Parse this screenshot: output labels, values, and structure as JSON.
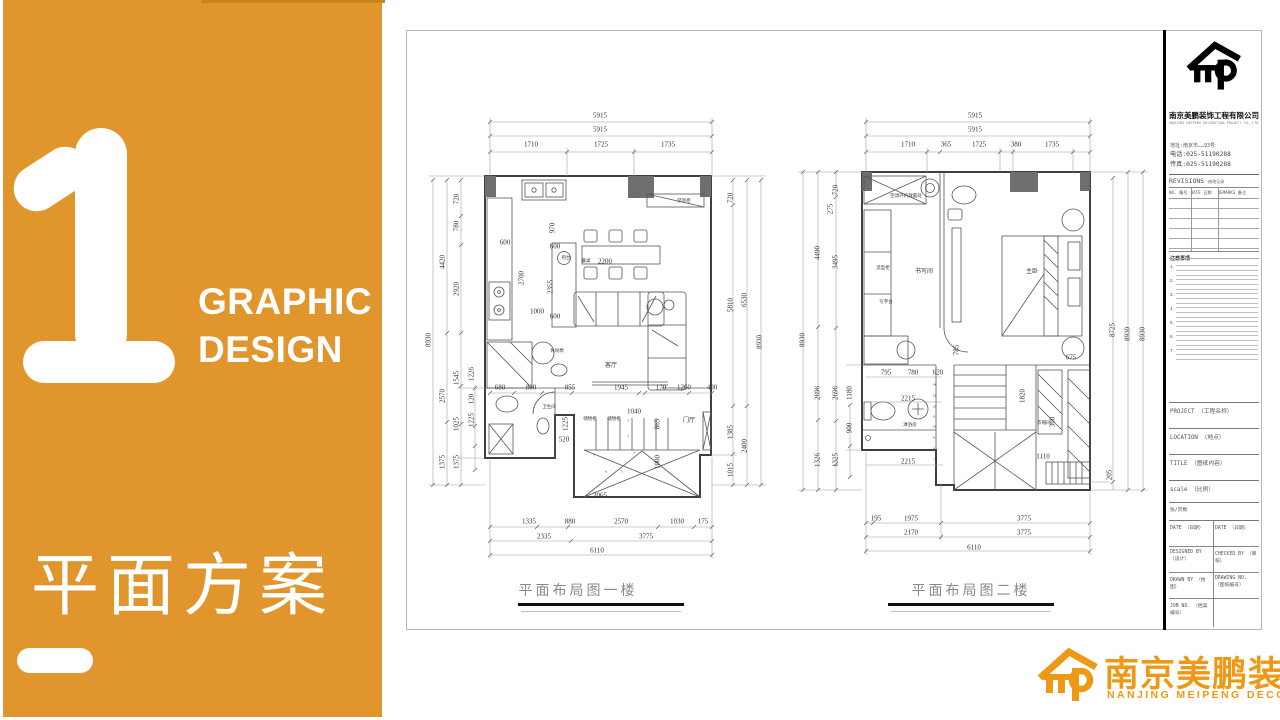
{
  "left_panel": {
    "number": "1",
    "subtitle_line1": "GRAPHIC",
    "subtitle_line2": "DESIGN",
    "title": "平面方案",
    "bg_color": "#E0952D"
  },
  "sheet": {
    "plan1": {
      "title": "平面布局图一楼",
      "dims": [
        {
          "t": "5915",
          "x": 600,
          "y": 116
        },
        {
          "t": "5915",
          "x": 600,
          "y": 130
        },
        {
          "t": "1710",
          "x": 531,
          "y": 145
        },
        {
          "t": "1725",
          "x": 601,
          "y": 145
        },
        {
          "t": "1735",
          "x": 668,
          "y": 145
        },
        {
          "t": "8930",
          "x": 429,
          "y": 340,
          "r": 1
        },
        {
          "t": "4420",
          "x": 443,
          "y": 262,
          "r": 1
        },
        {
          "t": "2570",
          "x": 443,
          "y": 396,
          "r": 1
        },
        {
          "t": "1375",
          "x": 443,
          "y": 462,
          "r": 1
        },
        {
          "t": "720",
          "x": 457,
          "y": 199,
          "r": 1
        },
        {
          "t": "780",
          "x": 457,
          "y": 226,
          "r": 1
        },
        {
          "t": "2920",
          "x": 457,
          "y": 289,
          "r": 1
        },
        {
          "t": "1545",
          "x": 457,
          "y": 378,
          "r": 1
        },
        {
          "t": "1025",
          "x": 457,
          "y": 424,
          "r": 1
        },
        {
          "t": "1375",
          "x": 457,
          "y": 462,
          "r": 1
        },
        {
          "t": "1226",
          "x": 472,
          "y": 374,
          "r": 1
        },
        {
          "t": "120",
          "x": 472,
          "y": 399,
          "r": 1
        },
        {
          "t": "1225",
          "x": 472,
          "y": 420,
          "r": 1
        },
        {
          "t": "720",
          "x": 731,
          "y": 198,
          "r": 1
        },
        {
          "t": "5810",
          "x": 731,
          "y": 305,
          "r": 1
        },
        {
          "t": "1385",
          "x": 731,
          "y": 432,
          "r": 1
        },
        {
          "t": "1015",
          "x": 731,
          "y": 470,
          "r": 1
        },
        {
          "t": "6530",
          "x": 745,
          "y": 300,
          "r": 1
        },
        {
          "t": "2400",
          "x": 745,
          "y": 446,
          "r": 1
        },
        {
          "t": "8930",
          "x": 760,
          "y": 342,
          "r": 1
        },
        {
          "t": "1335",
          "x": 529,
          "y": 522
        },
        {
          "t": "880",
          "x": 570,
          "y": 522
        },
        {
          "t": "2570",
          "x": 621,
          "y": 522
        },
        {
          "t": "1030",
          "x": 677,
          "y": 522
        },
        {
          "t": "175",
          "x": 703,
          "y": 522
        },
        {
          "t": "2335",
          "x": 544,
          "y": 537
        },
        {
          "t": "3775",
          "x": 646,
          "y": 537
        },
        {
          "t": "6110",
          "x": 597,
          "y": 551
        },
        {
          "t": "600",
          "x": 505,
          "y": 243
        },
        {
          "t": "2700",
          "x": 522,
          "y": 278,
          "r": 1
        },
        {
          "t": "1000",
          "x": 537,
          "y": 312
        },
        {
          "t": "970",
          "x": 553,
          "y": 228,
          "r": 1
        },
        {
          "t": "600",
          "x": 555,
          "y": 247
        },
        {
          "t": "2355",
          "x": 551,
          "y": 287,
          "r": 1
        },
        {
          "t": "600",
          "x": 555,
          "y": 317
        },
        {
          "t": "2200",
          "x": 605,
          "y": 262
        },
        {
          "t": "680",
          "x": 500,
          "y": 388
        },
        {
          "t": "800",
          "x": 531,
          "y": 388
        },
        {
          "t": "855",
          "x": 570,
          "y": 388
        },
        {
          "t": "1945",
          "x": 621,
          "y": 388
        },
        {
          "t": "170",
          "x": 661,
          "y": 388
        },
        {
          "t": "1260",
          "x": 684,
          "y": 388
        },
        {
          "t": "400",
          "x": 712,
          "y": 388
        },
        {
          "t": "520",
          "x": 564,
          "y": 440
        },
        {
          "t": "1040",
          "x": 634,
          "y": 412
        },
        {
          "t": "865",
          "x": 658,
          "y": 424,
          "r": 1
        },
        {
          "t": "1000",
          "x": 658,
          "y": 462,
          "r": 1
        },
        {
          "t": "2065",
          "x": 600,
          "y": 496
        },
        {
          "t": "1225",
          "x": 566,
          "y": 424,
          "r": 1
        },
        {
          "t": "3",
          "x": 628,
          "y": 421,
          "s": 3.5
        },
        {
          "t": "2",
          "x": 628,
          "y": 436,
          "s": 3.5
        },
        {
          "t": "7",
          "x": 594,
          "y": 456,
          "s": 3.5
        },
        {
          "t": "6",
          "x": 606,
          "y": 472,
          "s": 3.5
        },
        {
          "t": "5",
          "x": 622,
          "y": 472,
          "s": 3.5
        },
        {
          "t": "4",
          "x": 634,
          "y": 453,
          "s": 3.5
        }
      ],
      "labels": [
        {
          "t": "装饰柜",
          "x": 684,
          "y": 201,
          "s": 4.5
        },
        {
          "t": "吧台",
          "x": 566,
          "y": 258,
          "s": 4.5
        },
        {
          "t": "餐桌",
          "x": 586,
          "y": 261,
          "s": 4.5
        },
        {
          "t": "客厅",
          "x": 611,
          "y": 366
        },
        {
          "t": "休闲椅",
          "x": 557,
          "y": 351,
          "s": 4.5
        },
        {
          "t": "储物柜",
          "x": 590,
          "y": 419,
          "s": 4.5
        },
        {
          "t": "储物柜",
          "x": 614,
          "y": 419,
          "s": 4.5
        },
        {
          "t": "卫生间",
          "x": 549,
          "y": 407,
          "s": 4.5
        },
        {
          "t": "门厅",
          "x": 689,
          "y": 421
        }
      ]
    },
    "plan2": {
      "title": "平面布局图二楼",
      "dims": [
        {
          "t": "5915",
          "x": 975,
          "y": 116
        },
        {
          "t": "5915",
          "x": 975,
          "y": 130
        },
        {
          "t": "1710",
          "x": 908,
          "y": 145
        },
        {
          "t": "365",
          "x": 946,
          "y": 145
        },
        {
          "t": "1725",
          "x": 979,
          "y": 145
        },
        {
          "t": "380",
          "x": 1016,
          "y": 145
        },
        {
          "t": "1735",
          "x": 1052,
          "y": 145
        },
        {
          "t": "8930",
          "x": 803,
          "y": 340,
          "r": 1
        },
        {
          "t": "4490",
          "x": 818,
          "y": 253,
          "r": 1
        },
        {
          "t": "2696",
          "x": 818,
          "y": 393,
          "r": 1
        },
        {
          "t": "1326",
          "x": 818,
          "y": 460,
          "r": 1
        },
        {
          "t": "720",
          "x": 836,
          "y": 190,
          "r": 1
        },
        {
          "t": "275",
          "x": 831,
          "y": 209,
          "r": 1
        },
        {
          "t": "3495",
          "x": 836,
          "y": 262,
          "r": 1
        },
        {
          "t": "2696",
          "x": 836,
          "y": 393,
          "r": 1
        },
        {
          "t": "1325",
          "x": 836,
          "y": 460,
          "r": 1
        },
        {
          "t": "1180",
          "x": 850,
          "y": 393,
          "r": 1
        },
        {
          "t": "900",
          "x": 850,
          "y": 428,
          "r": 1
        },
        {
          "t": "8725",
          "x": 1113,
          "y": 330,
          "r": 1
        },
        {
          "t": "8930",
          "x": 1128,
          "y": 334,
          "r": 1
        },
        {
          "t": "8930",
          "x": 1143,
          "y": 334,
          "r": 1
        },
        {
          "t": "205",
          "x": 1110,
          "y": 475,
          "r": 1
        },
        {
          "t": "195",
          "x": 876,
          "y": 519
        },
        {
          "t": "1975",
          "x": 911,
          "y": 519
        },
        {
          "t": "3775",
          "x": 1024,
          "y": 519
        },
        {
          "t": "2170",
          "x": 911,
          "y": 533
        },
        {
          "t": "3775",
          "x": 1024,
          "y": 533
        },
        {
          "t": "6110",
          "x": 974,
          "y": 548
        },
        {
          "t": "795",
          "x": 886,
          "y": 373
        },
        {
          "t": "780",
          "x": 913,
          "y": 373
        },
        {
          "t": "620",
          "x": 938,
          "y": 373
        },
        {
          "t": "2215",
          "x": 908,
          "y": 399
        },
        {
          "t": "2215",
          "x": 908,
          "y": 462
        },
        {
          "t": "1110",
          "x": 1043,
          "y": 457
        },
        {
          "t": "675",
          "x": 1071,
          "y": 358
        },
        {
          "t": "785",
          "x": 957,
          "y": 350,
          "r": 1
        },
        {
          "t": "1820",
          "x": 1023,
          "y": 396,
          "r": 1
        },
        {
          "t": "360",
          "x": 1053,
          "y": 422,
          "r": 1
        },
        {
          "t": "14",
          "x": 934,
          "y": 385,
          "s": 3.5
        },
        {
          "t": "13",
          "x": 934,
          "y": 396,
          "s": 3.5
        },
        {
          "t": "12",
          "x": 934,
          "y": 407,
          "s": 3.5
        },
        {
          "t": "11",
          "x": 934,
          "y": 417,
          "s": 3.5
        },
        {
          "t": "10",
          "x": 934,
          "y": 427,
          "s": 3.5
        },
        {
          "t": "9",
          "x": 934,
          "y": 438,
          "s": 3.5
        },
        {
          "t": "8",
          "x": 934,
          "y": 449,
          "s": 3.5
        },
        {
          "t": "7",
          "x": 934,
          "y": 460,
          "s": 3.5
        }
      ],
      "labels": [
        {
          "t": "空调外机放置处",
          "x": 906,
          "y": 196,
          "s": 4.5
        },
        {
          "t": "造型柜",
          "x": 883,
          "y": 268,
          "s": 4.5
        },
        {
          "t": "书写间",
          "x": 924,
          "y": 272
        },
        {
          "t": "写字台",
          "x": 886,
          "y": 302,
          "s": 4.5
        },
        {
          "t": "主卧",
          "x": 1032,
          "y": 272
        },
        {
          "t": "淋浴房",
          "x": 910,
          "y": 425,
          "s": 4.5
        },
        {
          "t": "衣帽间",
          "x": 1044,
          "y": 423,
          "s": 4.5
        }
      ]
    },
    "titleblock": {
      "company_cn": "南京美鹏装饰工程有限公司",
      "company_en": "NANJING MEIPENG DECORATION PROJECT CO.,LTD",
      "address": "地址:南京市……93号",
      "tel": "电话:025-51190288",
      "fax": "传真:025-51190288",
      "revisions_label": "REVISIONS",
      "revisions_cn": "修改记录",
      "col_no": "NO. 编号",
      "col_date": "DATE 日期",
      "col_remarks": "REMARKS 备注",
      "notes_heading": "注意事项",
      "note_numbers": [
        "1.",
        "2.",
        "3.",
        "4.",
        "5.",
        "6.",
        "7."
      ],
      "fields": {
        "project": "PROJECT （工程名称）",
        "location": "LOCATION （地点）",
        "title": "TITLE （图纸内容）",
        "scale": "scale （比例）",
        "pages": "张/页数",
        "date1": "DATE （日期）",
        "date2": "DATE （日期）",
        "designed": "DESIGNED BY （设计）",
        "checked": "CHECKED BY （审核）",
        "drawn": "DRAWN BY （绘图）",
        "drawing_no": "DRAWING NO. （图纸编号）",
        "job_no": "JOB NO. （档案编号）"
      }
    }
  },
  "footer_logo": {
    "name_cn": "南京美鹏装饰",
    "name_en": "NANJING MEIPENG DECORATION",
    "color": "#EE9916"
  }
}
